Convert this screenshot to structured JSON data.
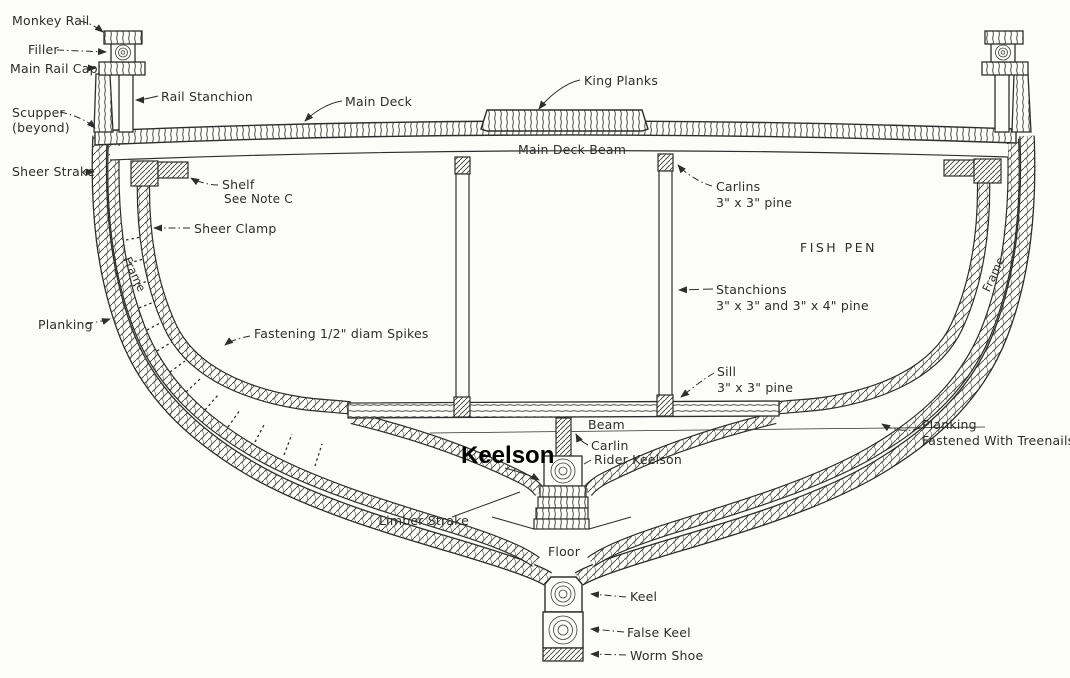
{
  "colors": {
    "ink": "#2e2e2e",
    "paper": "#fcfcf9",
    "bold_label": "#000000"
  },
  "labels": {
    "monkey_rail": "Monkey Rail",
    "filler": "Filler",
    "main_rail_cap": "Main Rail Cap",
    "rail_stanchion": "Rail Stanchion",
    "scupper_line1": "Scupper",
    "scupper_line2": "(beyond)",
    "sheer_strake": "Sheer Strake",
    "main_deck": "Main Deck",
    "king_planks": "King Planks",
    "main_deck_beam": "Main Deck Beam",
    "shelf_line1": "Shelf",
    "shelf_line2": "See Note C",
    "sheer_clamp": "Sheer Clamp",
    "frame_left": "Frame",
    "frame_right": "Frame",
    "planking_left": "Planking",
    "fastening_spikes": "Fastening 1/2\" diam Spikes",
    "carlins_line1": "Carlins",
    "carlins_line2": "3\" x 3\" pine",
    "fish_pen": "FISH PEN",
    "stanchions_line1": "Stanchions",
    "stanchions_line2": "3\" x 3\" and 3\" x 4\" pine",
    "sill_line1": "Sill",
    "sill_line2": "3\" x 3\" pine",
    "beam": "Beam",
    "carlin": "Carlin",
    "keelson_bold": "Keelson",
    "rider_keelson": "Rider Keelson",
    "limber_strake": "Limber Strake",
    "floor": "Floor",
    "keel": "Keel",
    "false_keel": "False Keel",
    "worm_shoe": "Worm Shoe",
    "planking_right_line1": "Planking",
    "planking_right_line2": "Fastened With Treenails"
  }
}
